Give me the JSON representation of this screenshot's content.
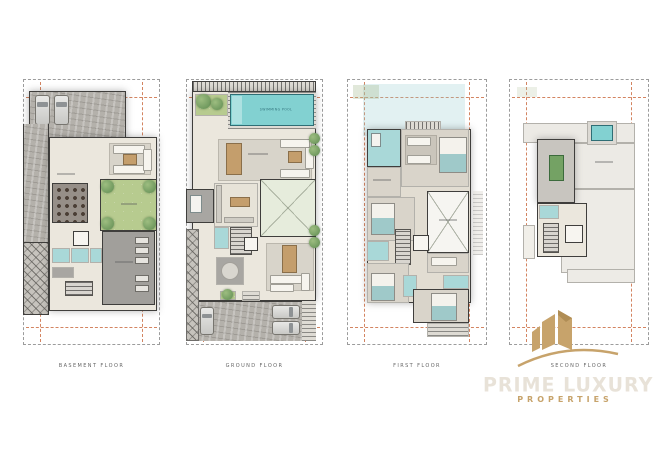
{
  "floors": [
    {
      "id": "basement",
      "label": "BASEMENT FLOOR"
    },
    {
      "id": "ground",
      "label": "GROUND FLOOR",
      "pool_label": "SWIMMING POOL"
    },
    {
      "id": "first",
      "label": "FIRST FLOOR"
    },
    {
      "id": "second",
      "label": "SECOND FLOOR"
    }
  ],
  "watermark": {
    "line1": "PRIME LUXURY",
    "line2": "PROPERTIES"
  },
  "colors": {
    "gold": "#c7a36b",
    "pool_teal": "#82d1d1",
    "garden_green": "#b7cb8f",
    "wall_dark": "#3f3e3c",
    "boundary_dash": "#9c9c9c",
    "setback_dash": "#cb6f45"
  }
}
